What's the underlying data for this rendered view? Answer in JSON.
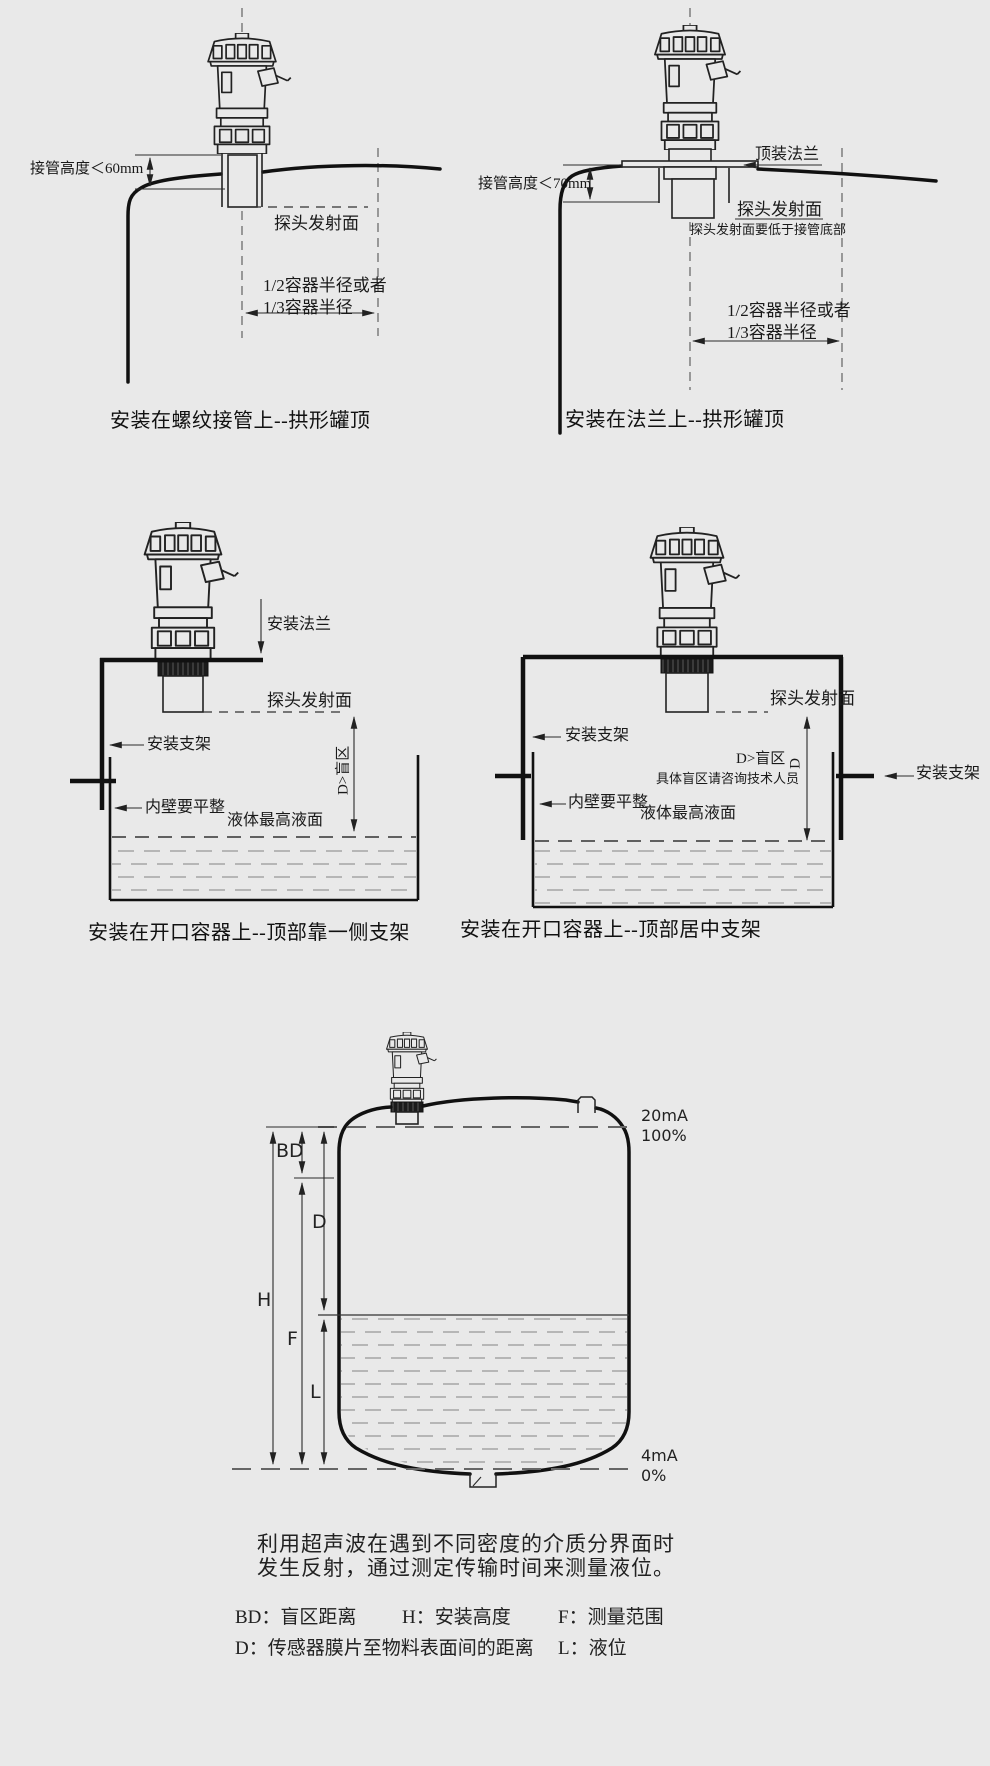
{
  "colors": {
    "background": "#e9e9e9",
    "line": "#1c1c1c",
    "liquid_dash": "#999"
  },
  "top_left": {
    "caption": "安装在螺纹接管上--拱形罐顶",
    "nozzle_height": "接管高度＜60mm",
    "probe_face": "探头发射面",
    "radius_line1": "1/2容器半径或者",
    "radius_line2": "1/3容器半径"
  },
  "top_right": {
    "caption": "安装在法兰上--拱形罐顶",
    "top_flange": "顶装法兰",
    "nozzle_height": "接管高度＜70mm",
    "probe_face": "探头发射面",
    "probe_face_note": "探头发射面要低于接管底部",
    "radius_line1": "1/2容器半径或者",
    "radius_line2": "1/3容器半径"
  },
  "mid_left": {
    "caption": "安装在开口容器上--顶部靠一侧支架",
    "mount_flange": "安装法兰",
    "probe_face": "探头发射面",
    "bracket": "安装支架",
    "blind_zone": "D>盲区",
    "wall_note": "内壁要平整",
    "max_level": "液体最高液面"
  },
  "mid_right": {
    "caption": "安装在开口容器上--顶部居中支架",
    "probe_face": "探头发射面",
    "bracket_left": "安装支架",
    "bracket_right": "安装支架",
    "blind_zone": "D>盲区",
    "blind_zone_dim": "D",
    "blind_note": "具体盲区请咨询技术人员",
    "wall_note": "内壁要平整",
    "max_level": "液体最高液面"
  },
  "bottom": {
    "dim_bd": "BD",
    "dim_d": "D",
    "dim_h": "H",
    "dim_f": "F",
    "dim_l": "L",
    "out_max_ma": "20mA",
    "out_max_pct": "100%",
    "out_min_ma": "4mA",
    "out_min_pct": "0%"
  },
  "description": {
    "line1": "利用超声波在遇到不同密度的介质分界面时",
    "line2": "发生反射，通过测定传输时间来测量液位。"
  },
  "legend": {
    "items": [
      "BD：盲区距离",
      "H：安装高度",
      "F：测量范围",
      "D：传感器膜片至物料表面间的距离",
      "L：液位"
    ]
  }
}
